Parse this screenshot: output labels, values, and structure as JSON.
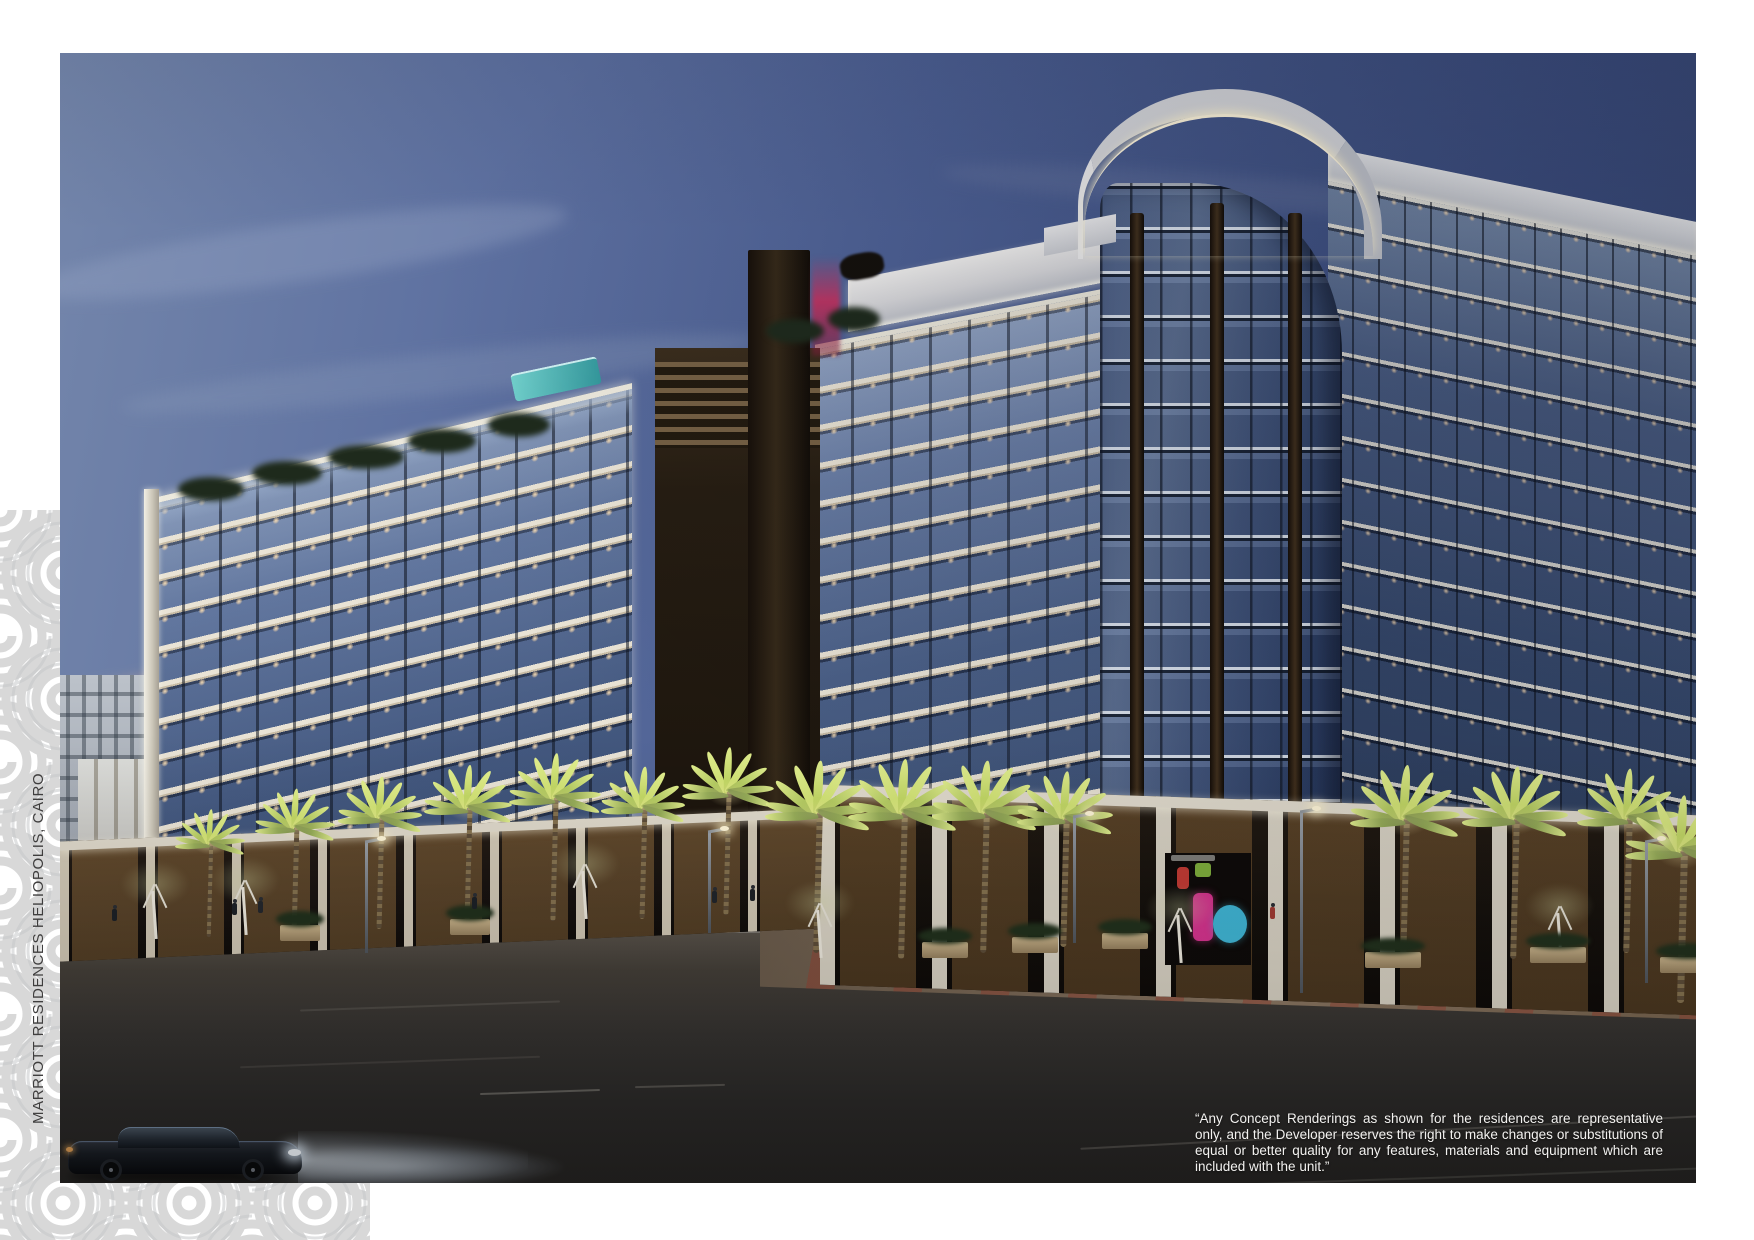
{
  "page": {
    "caption_vertical": "MARRIOTT RESIDENCES HELIOPOLIS, CAIRO",
    "disclaimer": "“Any Concept Renderings as shown for the residences are representative only, and the Developer reserves the right to make changes or substitutions of equal or better quality for any features, materials and equipment which are included with the unit.”"
  },
  "image": {
    "description": "Dusk architectural rendering of Marriott Residences Heliopolis, Cairo: a 12-storey residential block with glass balconies, a curved glass corner tower with white illuminated crown, bronze louvered fins, lit retail storefronts with palm trees at street level, and a black sedan driving on the foreground road",
    "colors": {
      "sky_left": "#6d80a8",
      "sky_right": "#36466f",
      "horizon_glow": "#dcab8d",
      "facade_glass": "#41567e",
      "slab_white": "#e6e1d3",
      "bronze_fin": "#2a2014",
      "storefront_glow": "#eab969",
      "palm_green": "#b5cc5e",
      "road": "#34312d",
      "pattern_gray": "#d5d5d5",
      "accent_pink": "#c2407e",
      "accent_cyan": "#3fb6d6"
    }
  }
}
